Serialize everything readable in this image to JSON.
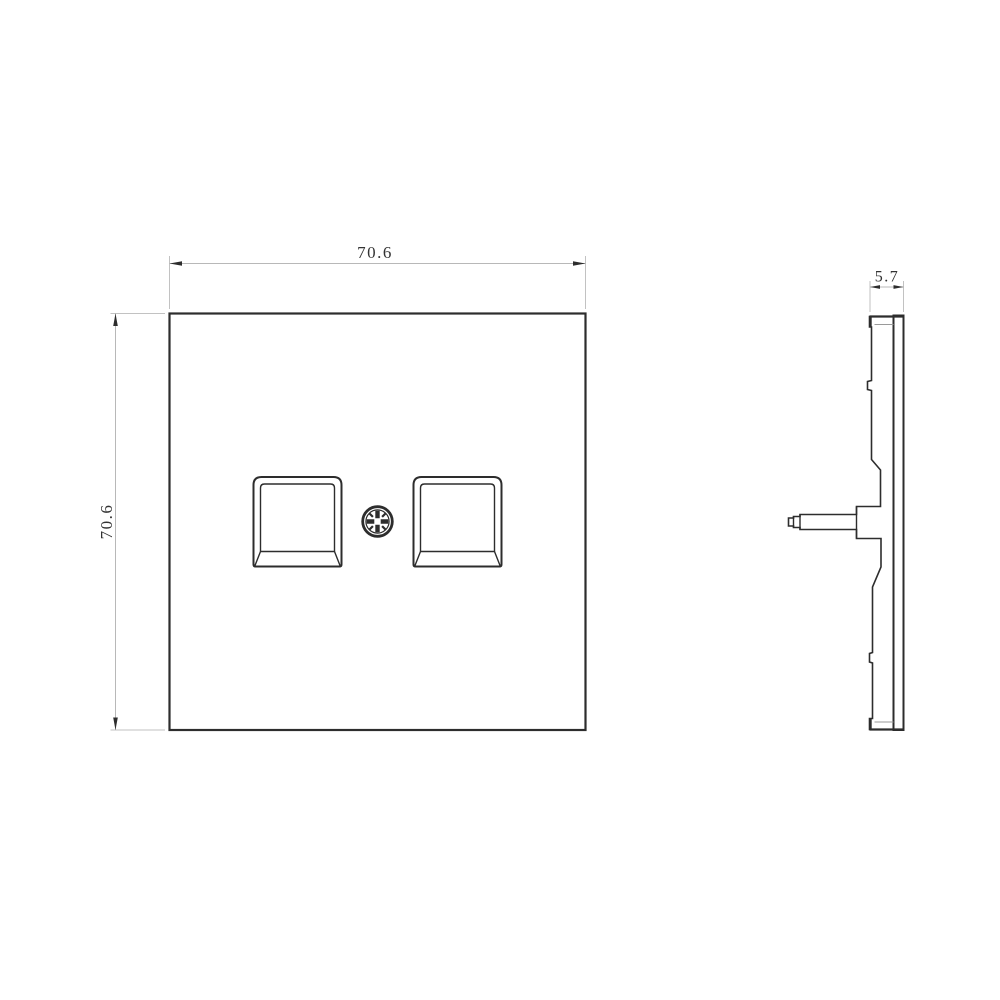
{
  "colors": {
    "background": "#ffffff",
    "outline": "#2d2d2d",
    "dimension_line": "#b8b8b8",
    "extension_line": "#c2c2c2",
    "arrow": "#2d2d2d",
    "dimension_text": "#333333"
  },
  "front_view": {
    "width_dimension": "70.6",
    "height_dimension": "70.6"
  },
  "side_view": {
    "thickness_dimension": "5.7"
  }
}
